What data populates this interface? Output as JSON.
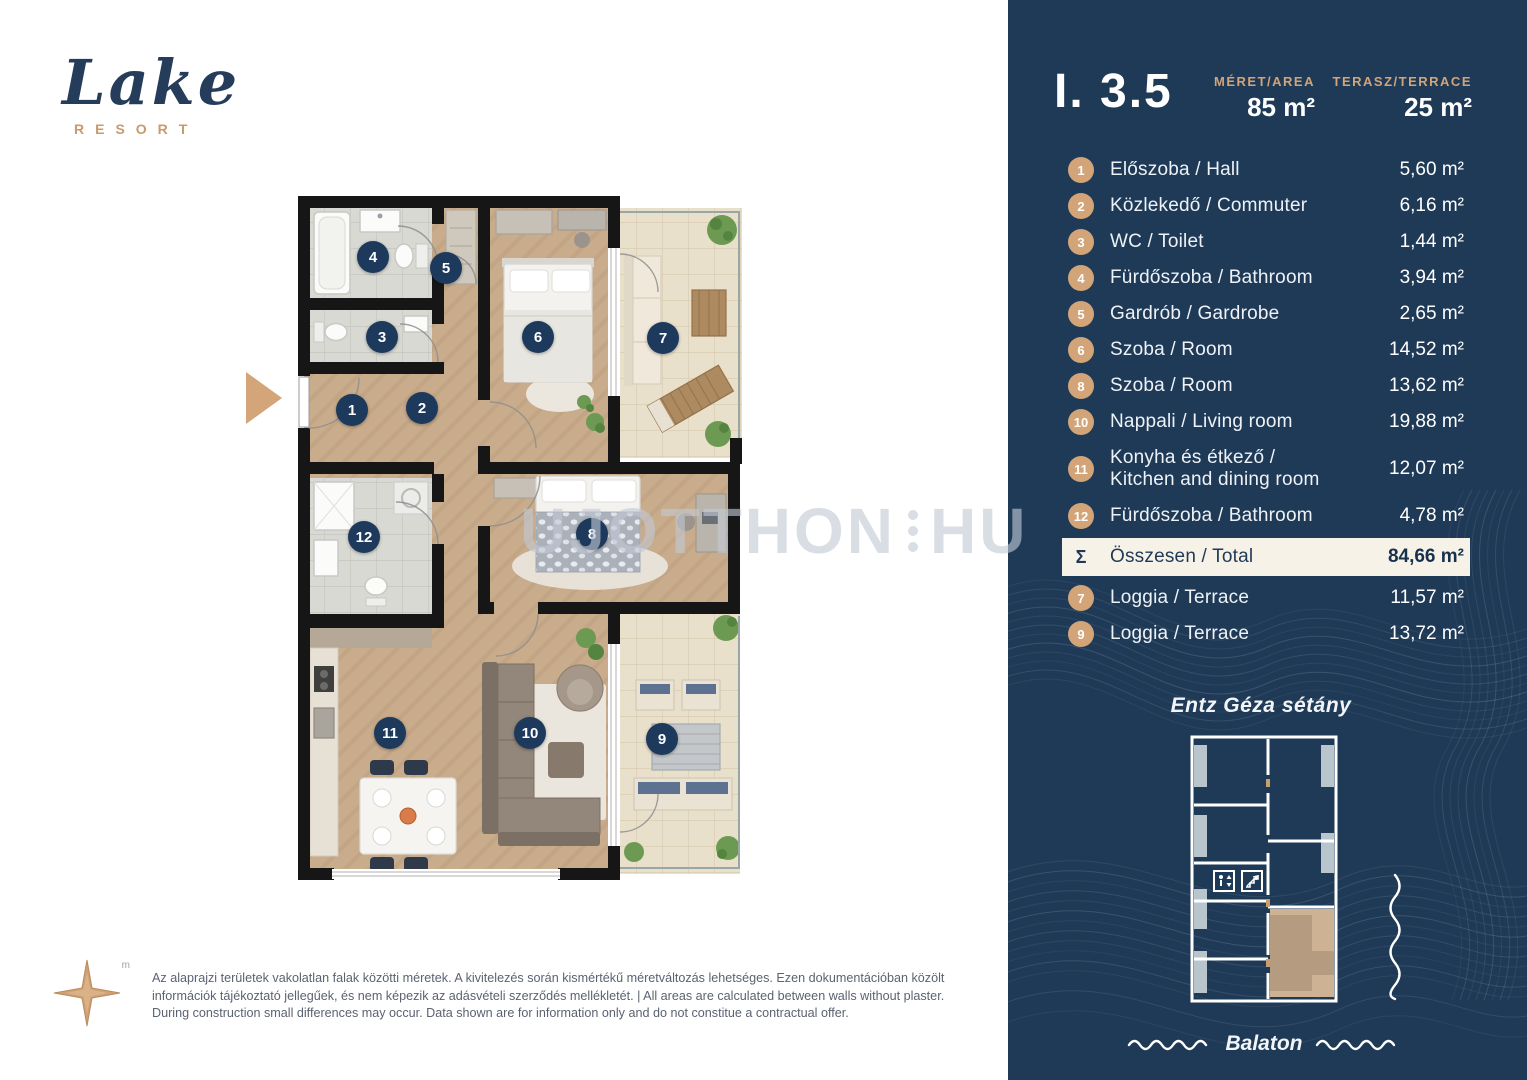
{
  "logo": {
    "name": "Lake",
    "subtitle": "RESORT",
    "trademark": "m"
  },
  "header": {
    "unit_id": "I. 3.5",
    "area_label": "MÉRET/AREA",
    "area_value": "85 m²",
    "terrace_label": "TERASZ/TERRACE",
    "terrace_value": "25 m²"
  },
  "rooms": [
    {
      "num": "1",
      "name": "Előszoba / Hall",
      "area": "5,60 m²"
    },
    {
      "num": "2",
      "name": "Közlekedő / Commuter",
      "area": "6,16 m²"
    },
    {
      "num": "3",
      "name": "WC / Toilet",
      "area": "1,44 m²"
    },
    {
      "num": "4",
      "name": "Fürdőszoba / Bathroom",
      "area": "3,94 m²"
    },
    {
      "num": "5",
      "name": "Gardrób / Gardrobe",
      "area": "2,65 m²"
    },
    {
      "num": "6",
      "name": "Szoba / Room",
      "area": "14,52 m²"
    },
    {
      "num": "8",
      "name": "Szoba / Room",
      "area": "13,62 m²"
    },
    {
      "num": "10",
      "name": "Nappali / Living room",
      "area": "19,88 m²"
    },
    {
      "num": "11",
      "name": "Konyha és étkező /",
      "name2": "Kitchen and dining room",
      "area": "12,07 m²"
    },
    {
      "num": "12",
      "name": "Fürdőszoba / Bathroom",
      "area": "4,78 m²"
    }
  ],
  "total": {
    "symbol": "Σ",
    "name": "Összesen / Total",
    "area": "84,66 m²"
  },
  "terraces": [
    {
      "num": "7",
      "name": "Loggia / Terrace",
      "area": "11,57 m²"
    },
    {
      "num": "9",
      "name": "Loggia / Terrace",
      "area": "13,72 m²"
    }
  ],
  "location": {
    "street": "Entz Géza sétány",
    "water": "Balaton"
  },
  "watermark": {
    "text": "UJOTTHON",
    "suffix": "HU"
  },
  "disclaimer": "Az alaprajzi területek vakolatlan falak közötti méretek. A kivitelezés során kismértékű méretváltozás lehetséges. Ezen dokumentációban közölt információk tájékoztató jellegűek, és nem képezik az adásvételi szerződés mellékletét. | All areas are calculated between walls without plaster. During construction small differences may occur. Data shown are for information only and do not constitue a contractual offer.",
  "plan_badges": [
    {
      "n": "1",
      "x": 54,
      "y": 214
    },
    {
      "n": "2",
      "x": 124,
      "y": 212
    },
    {
      "n": "3",
      "x": 84,
      "y": 141
    },
    {
      "n": "4",
      "x": 75,
      "y": 61
    },
    {
      "n": "5",
      "x": 148,
      "y": 72
    },
    {
      "n": "6",
      "x": 240,
      "y": 141
    },
    {
      "n": "7",
      "x": 365,
      "y": 142
    },
    {
      "n": "8",
      "x": 294,
      "y": 338
    },
    {
      "n": "12",
      "x": 66,
      "y": 341
    },
    {
      "n": "11",
      "x": 92,
      "y": 537
    },
    {
      "n": "10",
      "x": 232,
      "y": 537
    },
    {
      "n": "9",
      "x": 364,
      "y": 543
    }
  ],
  "colors": {
    "sidebar_bg": "#1f3a57",
    "accent_tan": "#d2a478",
    "total_bg": "#f7f2e7",
    "badge_navy": "#1d3a5c",
    "logo_navy": "#253c5a",
    "wood_floor": "#c9ac8c",
    "terrace_tile": "#e9e0cb",
    "bath_tile": "#d9d9d4"
  }
}
